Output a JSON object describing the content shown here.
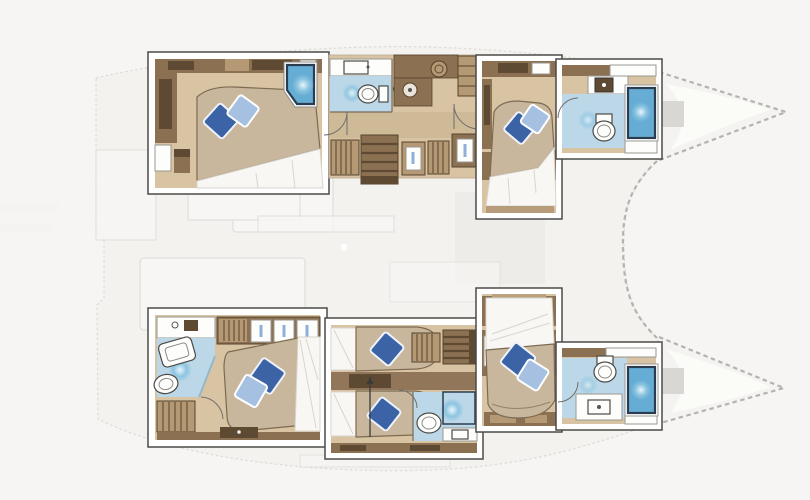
{
  "page": {
    "title": "Catamaran lower-deck cabin layout plan",
    "background": "#f6f5f3"
  },
  "colors": {
    "bg": "#f6f5f3",
    "frame": "#ffffff",
    "frameline": "#4b4a47",
    "wood": "#d8c3a3",
    "wood2": "#c9b28e",
    "cab": "#8c7052",
    "cab2": "#5e4a33",
    "cab3": "#b59874",
    "trim": "#55432c",
    "bed": "#c8b69d",
    "bededge": "#7d6b51",
    "sheet": "#f8f7f4",
    "sheetline": "#d9d5cd",
    "pillowdark": "#3c63a6",
    "pillowlight": "#a6c0e2",
    "bath": "#bcd8e8",
    "shower": "#66add5",
    "showerlt": "#dff2fa",
    "showerborder": "#2b3c4f",
    "fixture": "#fdfdfc",
    "fade": "#f3f2f0",
    "fadeline": "#dcdbd7",
    "fadewhite": "#f7f6f4",
    "dash": "#b5b3ae",
    "hatch": "#d8d7d3"
  },
  "plan": {
    "type": "yacht floor plan",
    "vessel": "sailing catamaran, twin hulls with pointed bows to the right",
    "view": "cabin deck drawn in full color over a faded main-deck silhouette",
    "upper_hull": {
      "rooms": [
        {
          "name": "aft double cabin",
          "features": [
            "double bed with two blue pillows",
            "corner shower cabin",
            "wardrobe"
          ]
        },
        {
          "name": "mid bathroom",
          "features": [
            "toilet",
            "vanity with sink"
          ]
        },
        {
          "name": "galley / companionway",
          "features": [
            "counter with sink and burner",
            "drawer cabinet",
            "stairs",
            "lockers"
          ]
        },
        {
          "name": "forward double cabin",
          "features": [
            "double bed with two blue pillows"
          ]
        },
        {
          "name": "forward bathroom",
          "features": [
            "toilet",
            "sink counter",
            "shower cabin"
          ]
        }
      ]
    },
    "lower_hull": {
      "rooms": [
        {
          "name": "aft master cabin",
          "features": [
            "large ensuite with shower tray and toilet",
            "hanging wardrobe",
            "double bed with two blue pillows",
            "slatted cabinet"
          ]
        },
        {
          "name": "twin single cabins",
          "features": [
            "two single beds each with one blue pillow",
            "stairs",
            "wardrobe",
            "small bathroom with toilet and shower"
          ]
        },
        {
          "name": "forward double cabin",
          "features": [
            "double bed with two blue pillows"
          ]
        },
        {
          "name": "forward bathroom",
          "features": [
            "toilet",
            "vanity with sink",
            "shower cabin"
          ]
        }
      ]
    },
    "counts": {
      "double_beds": 4,
      "single_beds": 2,
      "toilets": 5,
      "showers": 5,
      "deck_hatches": 2
    }
  }
}
